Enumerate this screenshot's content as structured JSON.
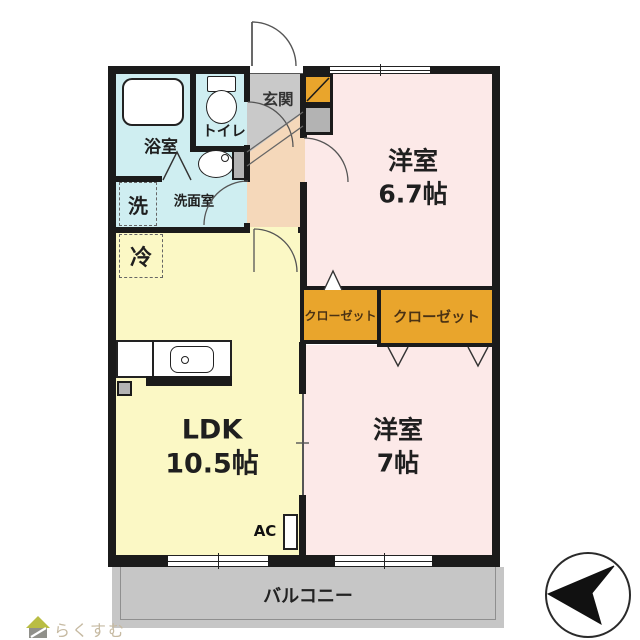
{
  "colors": {
    "walls": "#1b1b1b",
    "water": "#cfeef1",
    "hallway": "#f5d8ba",
    "entrance_gray": "#c9c9c9",
    "bedroom": "#fce9e8",
    "ldk": "#fbf8c5",
    "closet": "#e9a52c",
    "balcony": "#c6c6c6",
    "fixture_gray": "#b3b3b3",
    "logo_text": "#c6baa2",
    "logo_roof": "#b9bd44",
    "logo_body": "#90908a"
  },
  "rooms": {
    "bathroom": "浴室",
    "toilet": "トイレ",
    "washer": "洗",
    "washroom": "洗面室",
    "entrance": "玄関",
    "fridge": "冷",
    "bedroom1_name": "洋室",
    "bedroom1_size": "6.7帖",
    "closet_left": "クローゼット",
    "closet_right": "クローゼット",
    "ldk_name": "LDK",
    "ldk_size": "10.5帖",
    "bedroom2_name": "洋室",
    "bedroom2_size": "7帖",
    "ac_label": "AC",
    "balcony": "バルコニー"
  },
  "logo": {
    "text": "らくすむ"
  },
  "icons": {
    "compass": "north-arrow-compass",
    "logo_mark": "house-icon"
  }
}
